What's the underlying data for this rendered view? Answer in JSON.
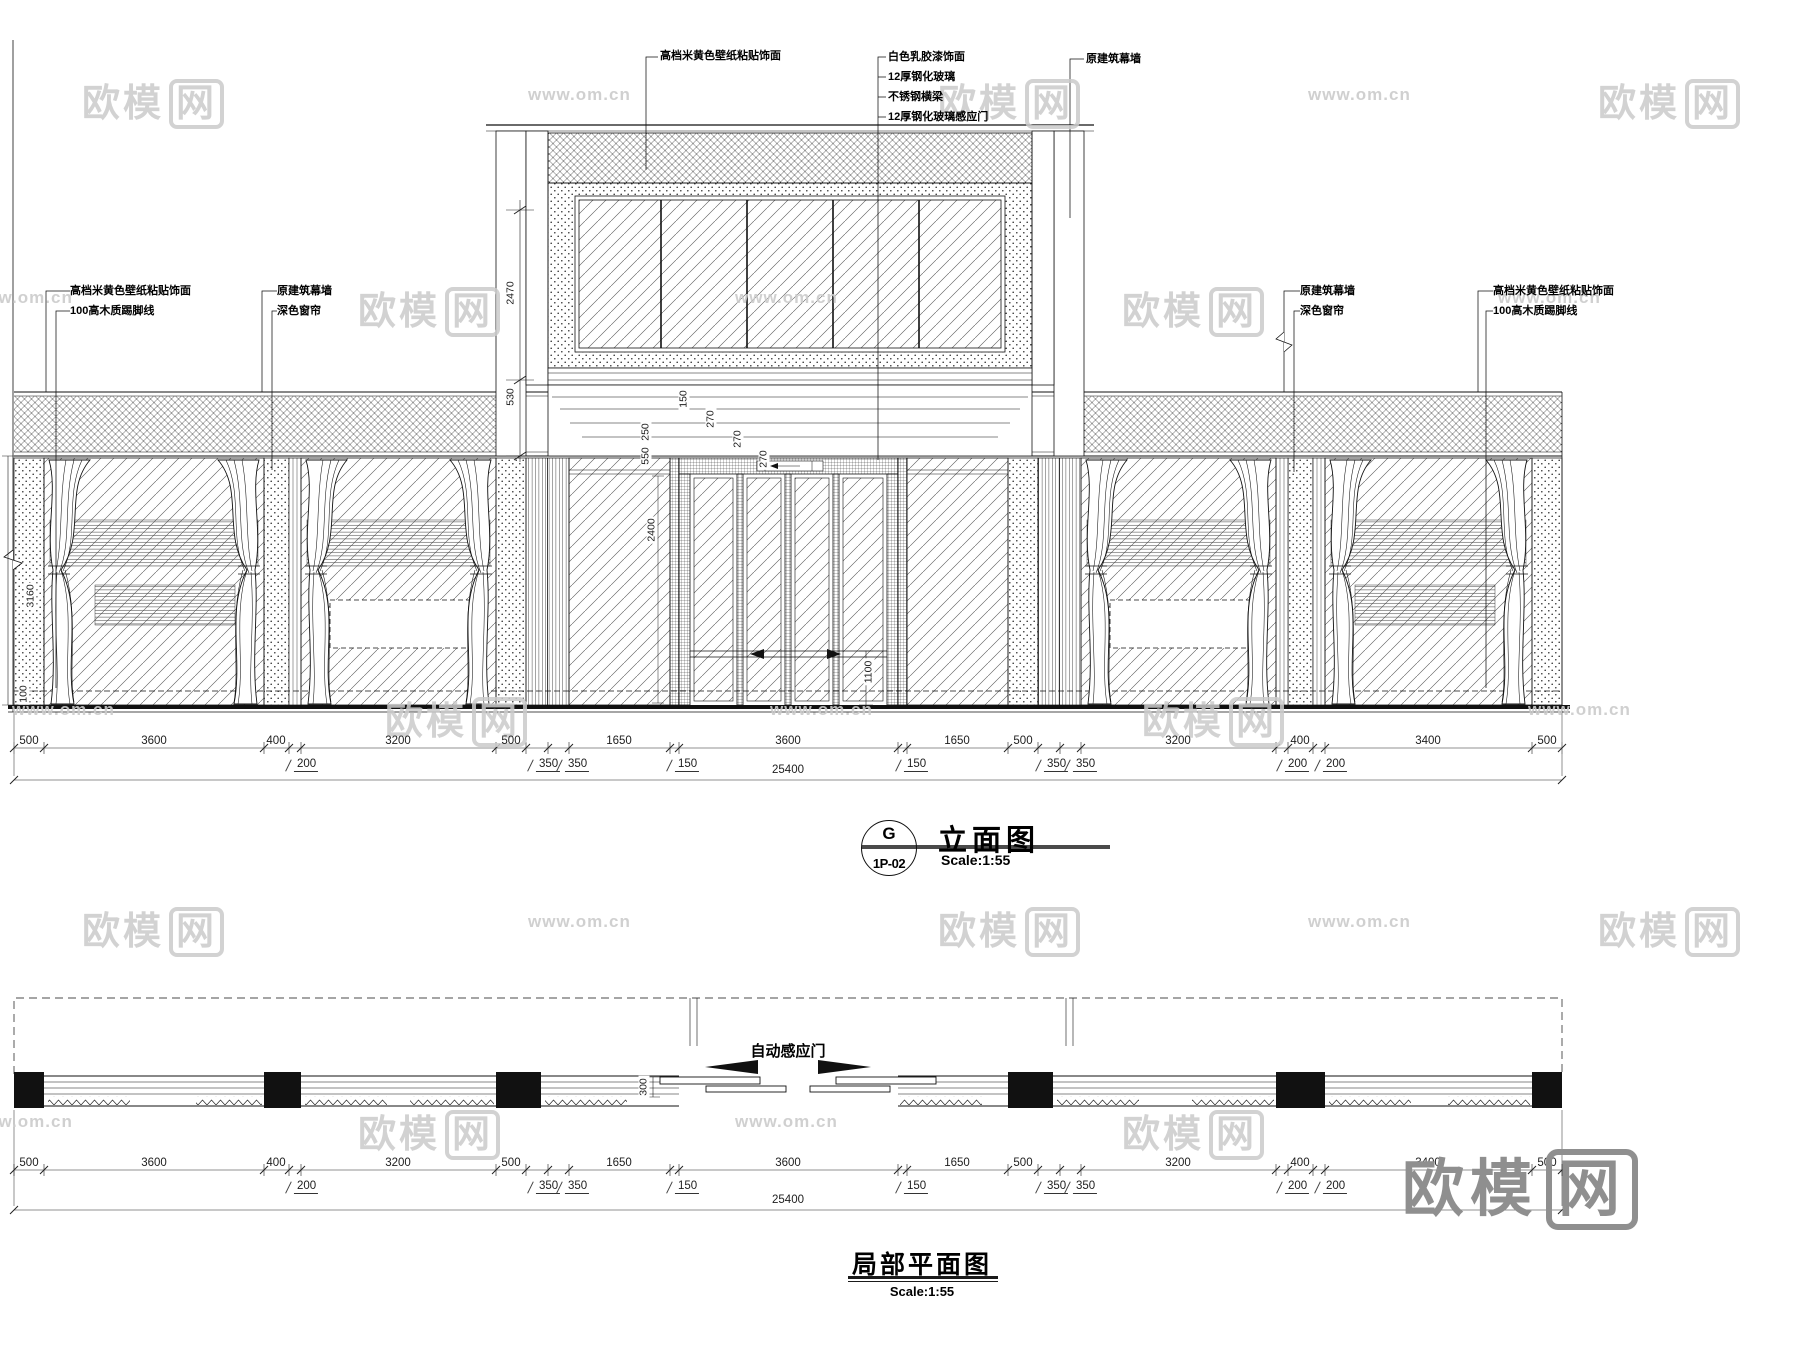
{
  "watermark": {
    "logo_prefix": "欧模",
    "logo_box": "网",
    "url": "www.om.cn",
    "color": "#cbcbcb",
    "big_color": "#8f8f8f",
    "logos": [
      {
        "x": 82,
        "y": 72
      },
      {
        "x": 938,
        "y": 72
      },
      {
        "x": 1598,
        "y": 72
      },
      {
        "x": 358,
        "y": 280
      },
      {
        "x": 1122,
        "y": 280
      },
      {
        "x": 385,
        "y": 690
      },
      {
        "x": 1142,
        "y": 690
      },
      {
        "x": 82,
        "y": 900
      },
      {
        "x": 938,
        "y": 900
      },
      {
        "x": 1598,
        "y": 900
      },
      {
        "x": 358,
        "y": 1103
      },
      {
        "x": 1122,
        "y": 1103
      }
    ],
    "urls": [
      {
        "x": 528,
        "y": 85
      },
      {
        "x": 1308,
        "y": 85
      },
      {
        "x": -30,
        "y": 288
      },
      {
        "x": 735,
        "y": 288
      },
      {
        "x": 1498,
        "y": 288
      },
      {
        "x": 12,
        "y": 700
      },
      {
        "x": 770,
        "y": 700
      },
      {
        "x": 1528,
        "y": 700
      },
      {
        "x": 528,
        "y": 912
      },
      {
        "x": 1308,
        "y": 912
      },
      {
        "x": -30,
        "y": 1112
      },
      {
        "x": 735,
        "y": 1112
      }
    ],
    "big": {
      "x": 1402,
      "y": 1138
    }
  },
  "callouts": {
    "top_left": "高档米黄色壁纸粘贴饰面",
    "top_center": [
      "白色乳胶漆饰面",
      "12厚钢化玻璃",
      "不锈钢横梁",
      "12厚钢化玻璃感应门"
    ],
    "top_right": "原建筑幕墙",
    "left_outer": [
      "高档米黄色壁纸粘贴饰面",
      "100高木质踢脚线"
    ],
    "left_inner": [
      "原建筑幕墙",
      "深色窗帘"
    ],
    "right_inner": [
      "原建筑幕墙",
      "深色窗帘"
    ],
    "right_outer": [
      "高档米黄色壁纸粘贴饰面",
      "100高木质踢脚线"
    ]
  },
  "door_label": "自动感应门",
  "dims": {
    "major": [
      {
        "t": "500",
        "x": 29
      },
      {
        "t": "3600",
        "x": 154
      },
      {
        "t": "400",
        "x": 276
      },
      {
        "t": "3200",
        "x": 398
      },
      {
        "t": "500",
        "x": 511
      },
      {
        "t": "1650",
        "x": 619
      },
      {
        "t": "3600",
        "x": 788
      },
      {
        "t": "1650",
        "x": 957
      },
      {
        "t": "500",
        "x": 1023
      },
      {
        "t": "3200",
        "x": 1178
      },
      {
        "t": "400",
        "x": 1300
      },
      {
        "t": "3400",
        "x": 1428
      },
      {
        "t": "500",
        "x": 1547
      }
    ],
    "minor": [
      {
        "t": "200",
        "x": 300
      },
      {
        "t": "350",
        "x": 542
      },
      {
        "t": "350",
        "x": 571
      },
      {
        "t": "150",
        "x": 681
      },
      {
        "t": "150",
        "x": 910
      },
      {
        "t": "350",
        "x": 1050
      },
      {
        "t": "350",
        "x": 1079
      },
      {
        "t": "200",
        "x": 1291
      },
      {
        "t": "200",
        "x": 1329
      }
    ],
    "total": "25400",
    "vertical": [
      {
        "t": "2470",
        "x": 511,
        "y": 293
      },
      {
        "t": "530",
        "x": 511,
        "y": 397
      },
      {
        "t": "3160",
        "x": 31,
        "y": 596
      },
      {
        "t": "100",
        "x": 24,
        "y": 694
      },
      {
        "t": "150",
        "x": 684,
        "y": 399
      },
      {
        "t": "270",
        "x": 711,
        "y": 419
      },
      {
        "t": "270",
        "x": 738,
        "y": 439
      },
      {
        "t": "270",
        "x": 764,
        "y": 459
      },
      {
        "t": "250",
        "x": 646,
        "y": 432
      },
      {
        "t": "550",
        "x": 646,
        "y": 456
      },
      {
        "t": "2400",
        "x": 652,
        "y": 530
      },
      {
        "t": "1100",
        "x": 869,
        "y": 672
      },
      {
        "t": "300",
        "x": 644,
        "y": 1087
      }
    ]
  },
  "titles": {
    "elevation": {
      "bubble_top": "G",
      "bubble_bottom": "1P-02",
      "name": "立面图",
      "scale": "Scale:1:55"
    },
    "plan": {
      "name": "局部平面图",
      "scale": "Scale:1:55"
    }
  }
}
